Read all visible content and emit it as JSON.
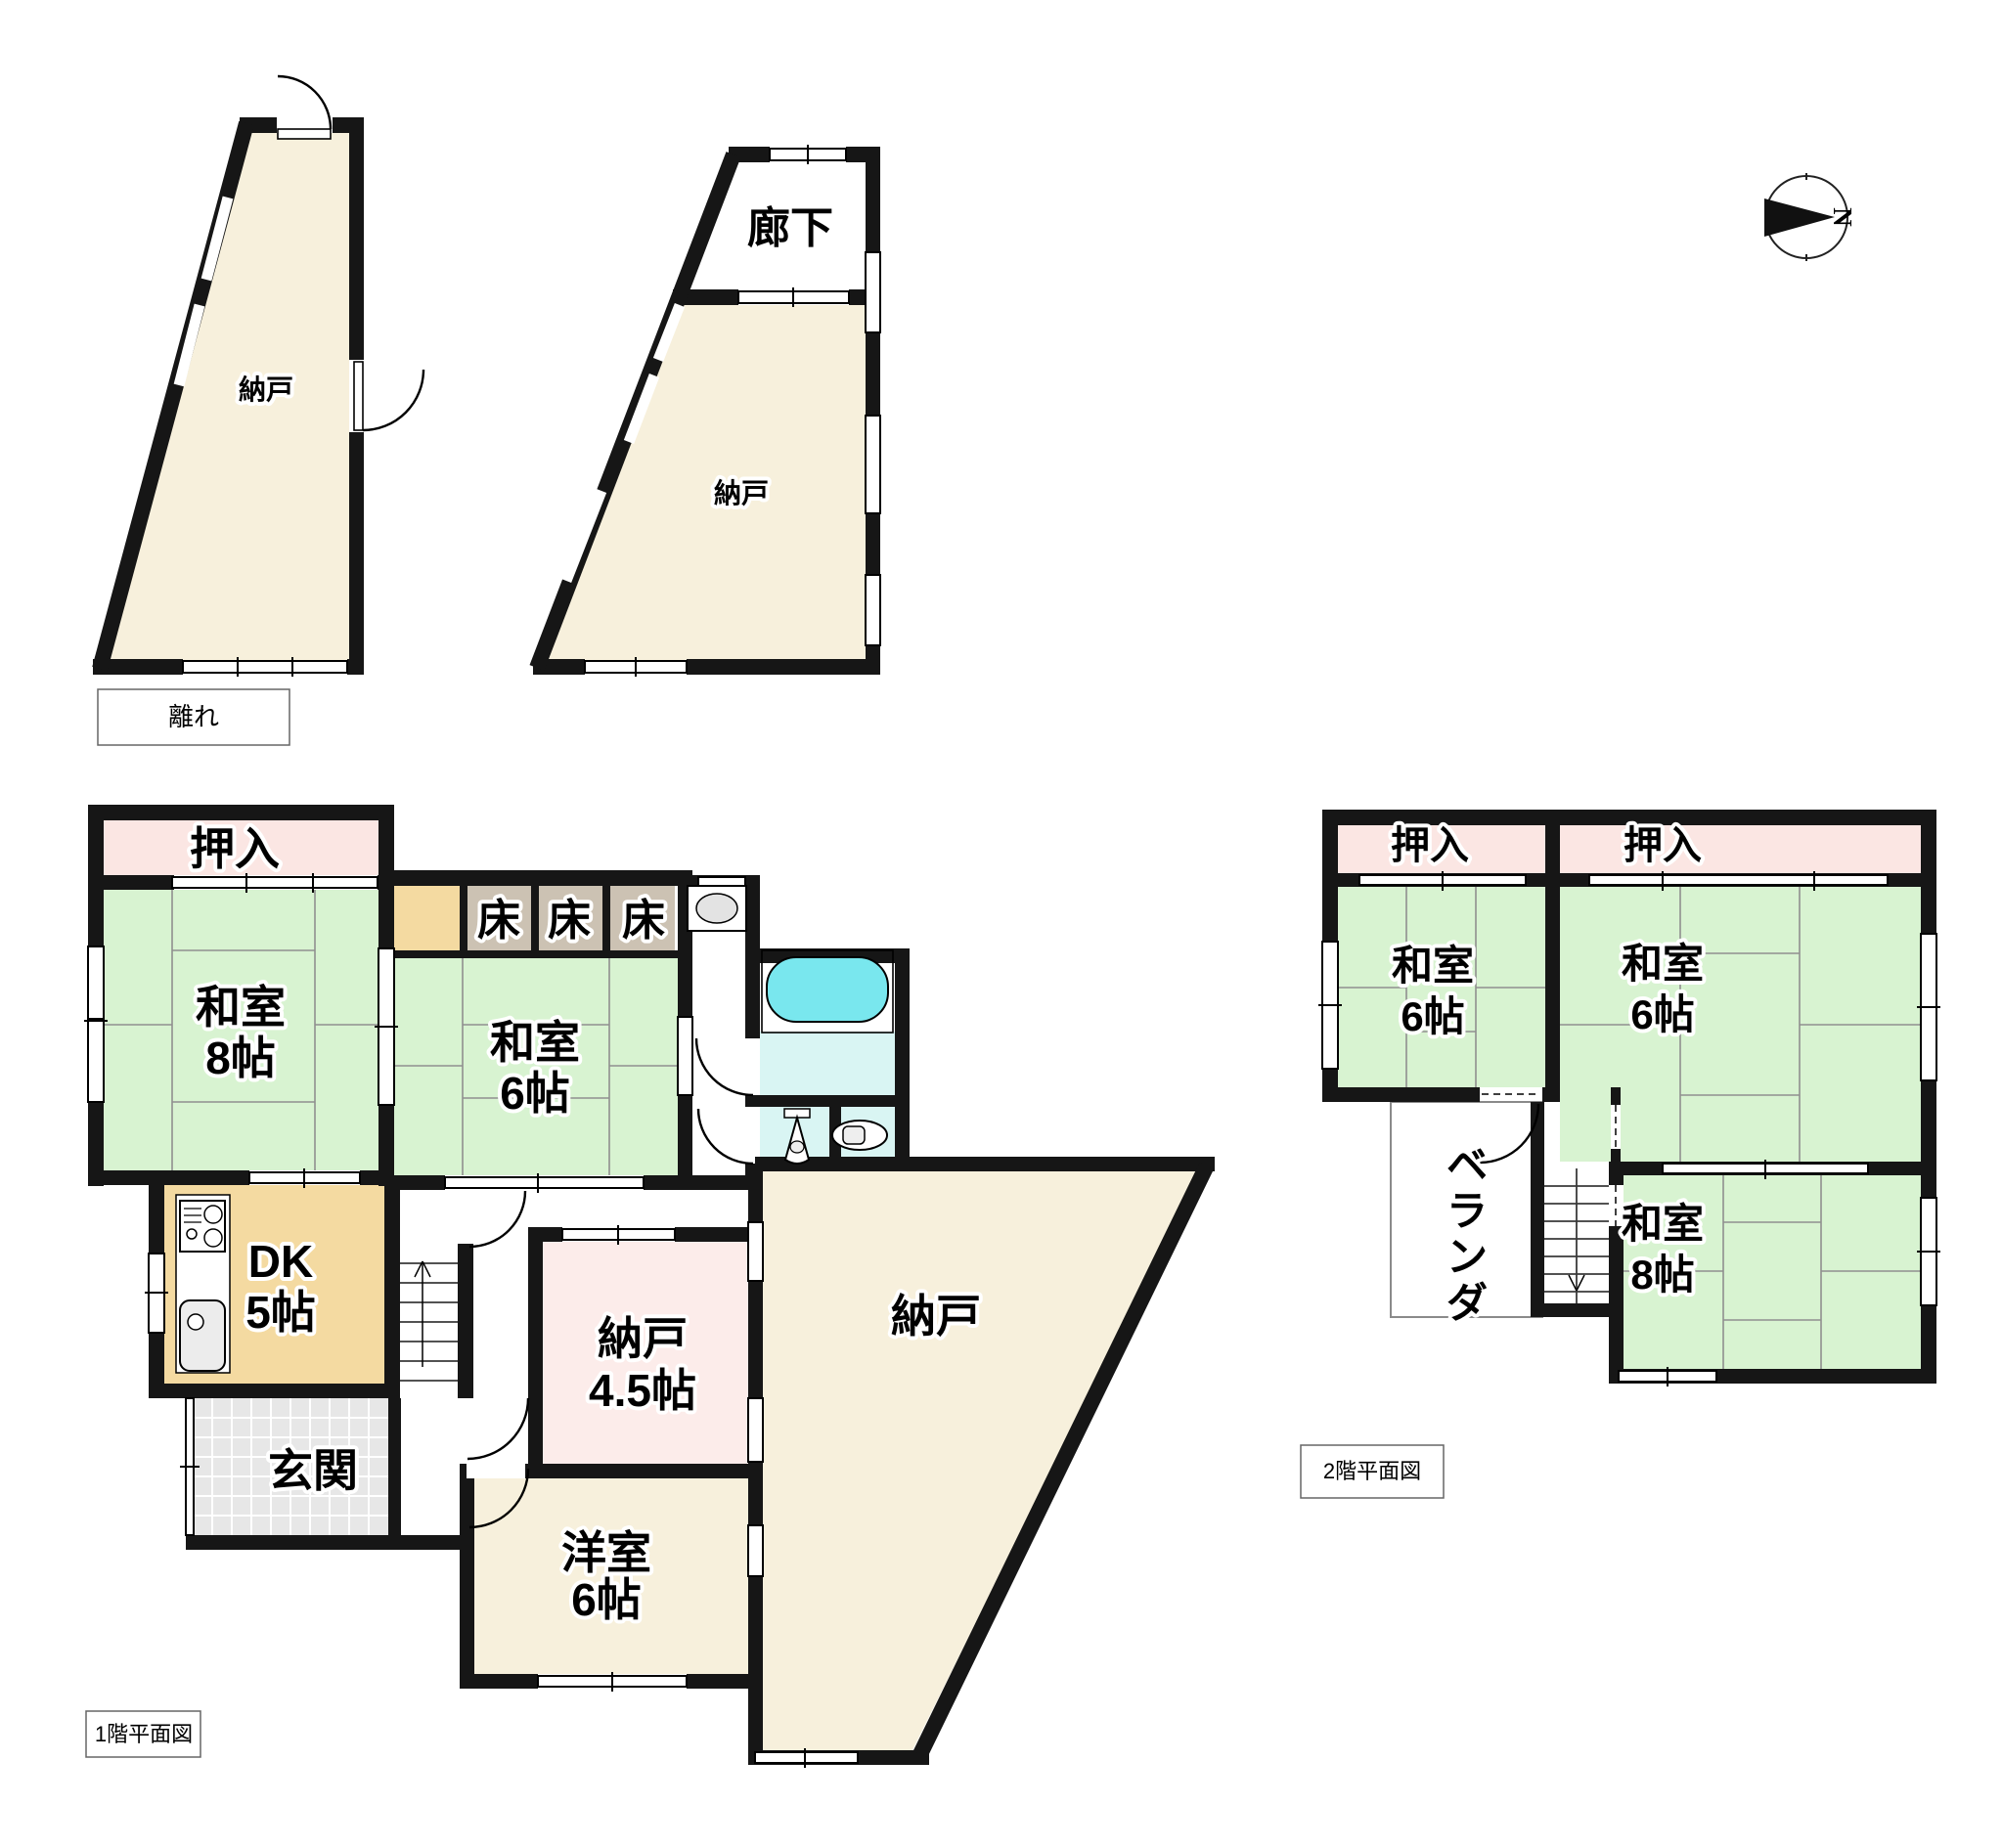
{
  "colors": {
    "wall": "#161616",
    "tatami_green": "#d8f3d1",
    "closet_pink": "#fbe6e3",
    "storage_cream": "#f7f0dc",
    "storage_pink": "#fcecea",
    "dk_tan": "#f4daa1",
    "tokonoma": "#ccc2b3",
    "entry_tile": "#e7e7e7",
    "bath_floor": "#d9f5f3",
    "bathtub": "#79e7ee"
  },
  "compass": {
    "north": "N"
  },
  "annex": {
    "caption": "離れ",
    "room1": "納戸",
    "corridor": "廊下",
    "room2": "納戸"
  },
  "floor1": {
    "caption": "1階平面図",
    "oshiire": "押入",
    "washitsu8": {
      "name": "和室",
      "size": "8帖"
    },
    "toko": "床",
    "washitsu6": {
      "name": "和室",
      "size": "6帖"
    },
    "dk": {
      "name": "DK",
      "size": "5帖"
    },
    "genkan": "玄関",
    "nando45": {
      "name": "納戸",
      "size": "4.5帖"
    },
    "youshitsu": {
      "name": "洋室",
      "size": "6帖"
    },
    "nando": "納戸"
  },
  "floor2": {
    "caption": "2階平面図",
    "oshiire_left": "押入",
    "oshiire_right": "押入",
    "washitsu6_left": {
      "name": "和室",
      "size": "6帖"
    },
    "washitsu6_right": {
      "name": "和室",
      "size": "6帖"
    },
    "washitsu8": {
      "name": "和室",
      "size": "8帖"
    },
    "veranda": {
      "c1": "ベ",
      "c2": "ラ",
      "c3": "ン",
      "c4": "ダ"
    }
  }
}
